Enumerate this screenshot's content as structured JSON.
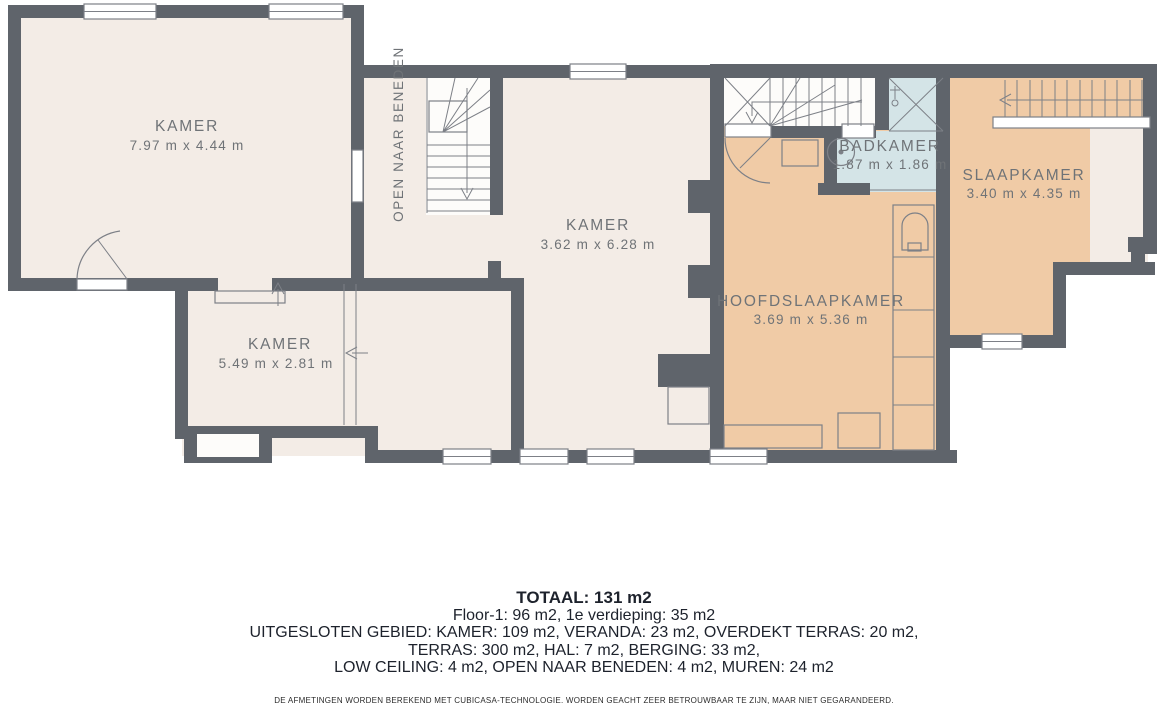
{
  "colors": {
    "wall": "#5f646b",
    "ivory": "#f3ece6",
    "tan": "#f0cba6",
    "blue": "#d4e4e7",
    "line": "#7d8087",
    "label": "#6f7377",
    "text_dark": "#1d222c"
  },
  "rooms": [
    {
      "id": "kamer-topleft",
      "name": "KAMER",
      "dims": "7.97 m x 4.44 m"
    },
    {
      "id": "kamer-middle",
      "name": "KAMER",
      "dims": "3.62 m x 6.28 m"
    },
    {
      "id": "kamer-bottomleft",
      "name": "KAMER",
      "dims": "5.49 m x 2.81 m"
    },
    {
      "id": "badkamer",
      "name": "BADKAMER",
      "dims": "1.87 m x 1.86 m"
    },
    {
      "id": "slaapkamer",
      "name": "SLAAPKAMER",
      "dims": "3.40 m x 4.35 m"
    },
    {
      "id": "hoofdslaapkamer",
      "name": "HOOFDSLAAPKAMER",
      "dims": "3.69 m x 5.36 m"
    }
  ],
  "annotations": {
    "open_naar_beneden": "OPEN NAAR BENEDEN"
  },
  "summary": {
    "total": "TOTAAL: 131 m2",
    "line2": "Floor-1: 96 m2, 1e verdieping: 35 m2",
    "line3": "UITGESLOTEN GEBIED: KAMER: 109 m2, VERANDA: 23 m2, OVERDEKT TERRAS: 20 m2,",
    "line4": "TERRAS: 300 m2, HAL: 7 m2, BERGING: 33 m2,",
    "line5": "LOW CEILING: 4 m2, OPEN NAAR BENEDEN: 4 m2, MUREN: 24 m2"
  },
  "disclaimer": "DE AFMETINGEN WORDEN BEREKEND MET CUBICASA-TECHNOLOGIE. WORDEN GEACHT ZEER BETROUWBAAR TE ZIJN, MAAR NIET GEGARANDEERD."
}
